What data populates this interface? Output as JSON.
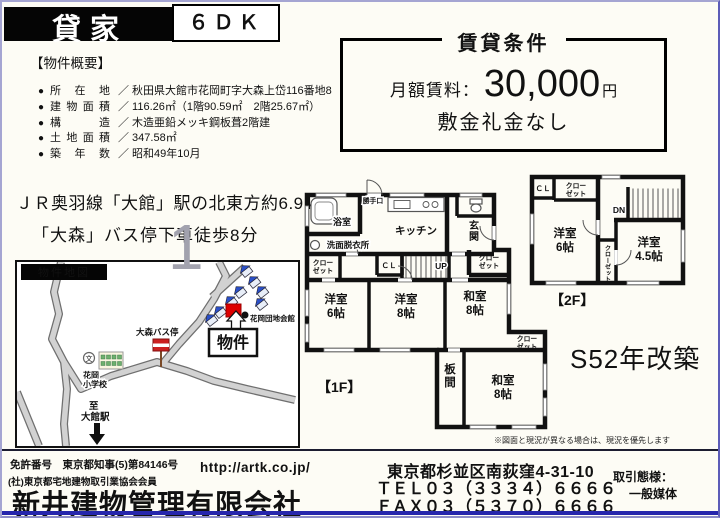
{
  "header": {
    "property_type": "貸家",
    "layout": "６ＤＫ"
  },
  "conditions": {
    "title": "賃貸条件",
    "rent_label": "月額賃料：",
    "rent_value": "30,000",
    "rent_unit": "円",
    "note": "敷金礼金なし"
  },
  "overview": {
    "heading": "【物件概要】",
    "bullet": "●",
    "separator": "／",
    "items": [
      {
        "label": "所在地",
        "value": "秋田県大館市花岡町字大森上岱116番地8"
      },
      {
        "label": "建物面積",
        "value": "116.26㎡（1階90.59㎡　2階25.67㎡）"
      },
      {
        "label": "構造",
        "value": "木造亜鉛メッキ鋼板葺2階建"
      },
      {
        "label": "土地面積",
        "value": "347.58㎡"
      },
      {
        "label": "築年数",
        "value": "昭和49年10月"
      }
    ]
  },
  "access": {
    "line1": "ＪＲ奥羽線「大館」駅の北東方約6.9ｋｍ",
    "line2": "「大森」バス停下車徒歩8分"
  },
  "map": {
    "title": "物件地図",
    "bus_stop": "大森バス停",
    "community_hall": "花岡団地会館",
    "property_label": "物件",
    "school_mark": "文",
    "school_l1": "花岡",
    "school_l2": "小学校",
    "to_station_l1": "至",
    "to_station_l2": "大館駅",
    "watermark": "1"
  },
  "floorplan": {
    "floor1": {
      "label": "【1F】",
      "bath": "浴室",
      "backdoor": "勝手口",
      "kitchen": "キッチン",
      "entrance_l1": "玄",
      "entrance_l2": "関",
      "washroom": "洗面脱衣所",
      "closet_l1": "クロー",
      "closet_l2": "ゼット",
      "cl": "ＣＬ",
      "up": "UP",
      "room_w6_name": "洋室",
      "room_w6_size": "6帖",
      "room_w8_name": "洋室",
      "room_w8_size": "8帖",
      "room_j8a_name": "和室",
      "room_j8a_size": "8帖",
      "itanoma_l1": "板",
      "itanoma_l2": "間",
      "room_j8b_name": "和室",
      "room_j8b_size": "8帖"
    },
    "floor2": {
      "label": "【2F】",
      "cl": "ＣＬ",
      "closet_l1": "クロー",
      "closet_l2": "ゼット",
      "dn": "DN",
      "closet_vertical": "クローゼット",
      "room_w6_name": "洋室",
      "room_w6_size": "6帖",
      "room_w45_name": "洋室",
      "room_w45_size": "4.5帖"
    },
    "renovation_note": "S52年改築",
    "disclaimer": "※図面と現況が異なる場合は、現況を優先します"
  },
  "footer": {
    "license_no": "免許番号　東京都知事(5)第84146号",
    "membership": "(社)東京都宅地建物取引業協会会員",
    "url": "http://artk.co.jp/",
    "company": "新井建物管理有限会社",
    "address": "東京都杉並区南荻窪4-31-10",
    "tel": "ＴＥＬ０３（３３３４）６６６６",
    "fax": "ＦＡＸ０３（５３７０）６６６６",
    "deal_type_label": "取引態様：",
    "deal_type_value": "一般媒体"
  },
  "colors": {
    "page_border": "#8c8cc8",
    "property_marker": "#dd0000",
    "house_roof": "#2b50c8",
    "bottom_bar": "#2626ac"
  }
}
